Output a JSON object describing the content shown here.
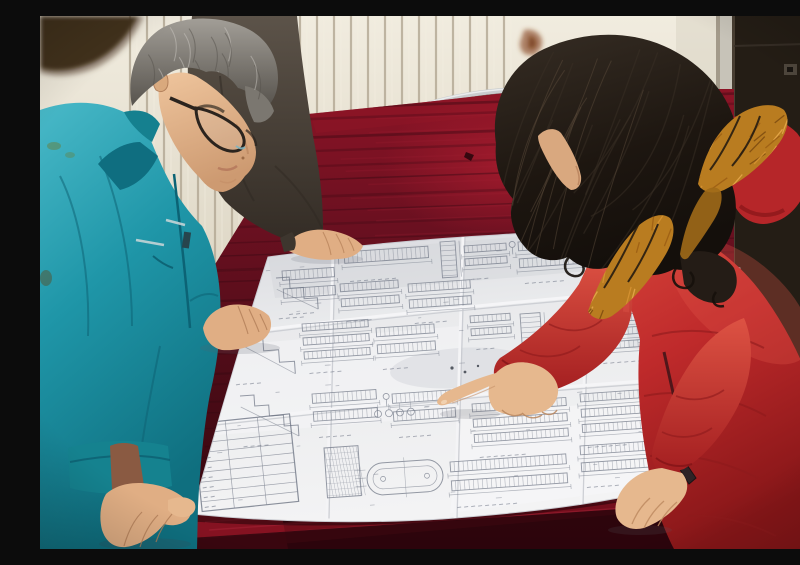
{
  "scene": {
    "caption": "Three people stand around a table covered in dark red velvet, examining a large unfolded engineering blueprint. A woman in a red down coat with an orange fur-trimmed hood points at a detail on the drawing while a gray-haired worker in a teal work jacket with glasses and a colleague in a dark jacket lean over the plans. Behind them is a cream radiator wall and a dark door.",
    "setting": "workshop office with cream radiator wall and dark door",
    "entities": {
      "wall": "cream radiator wall with vertical fins and a rust stain",
      "door": "dark brown door with light gray frame",
      "chair": "chrome-framed chair behind the table",
      "table": "table draped in dark red velvet",
      "blueprint": "large unfolded white engineering blueprint with fold creases, schedules and section drawings",
      "back_worker": "colleague in a dark jacket resting one hand on the blueprint",
      "left_worker": "gray-haired man in a teal work jacket and glasses leaning over the drawings",
      "left_worker_right_hand": "left worker's right hand resting on the blueprint",
      "left_worker_left_hand": "left worker's left hand holding the blueprint corner",
      "woman": "woman in a red quilted winter coat with orange fur-trimmed hood",
      "pointing_hand": "woman's hand pointing at a detail on the blueprint",
      "woman_left_hand": "woman's left hand resting on the blueprint"
    },
    "palette": {
      "wall": "#e9e3d4",
      "wall_fin": "#b2a793",
      "door": "#241d15",
      "door_frame": "#c7c3b8",
      "table_dark": "#4e0c18",
      "table_mid": "#7c1325",
      "table_bright": "#a01b2e",
      "paper": "#eceded",
      "ink": "#6f7685",
      "teal_jacket": "#1f96a8",
      "teal_dark": "#0d6375",
      "red_coat": "#c02a2b",
      "red_dark": "#8c1a1c",
      "fur": "#b97c20",
      "hair_gray": "#8d8a84",
      "hair_dark": "#221b15",
      "dark_jacket": "#4a423a",
      "skin": "#e0ae84",
      "skin_shadow": "#b07d58",
      "chrome": "#c9ccce"
    }
  }
}
